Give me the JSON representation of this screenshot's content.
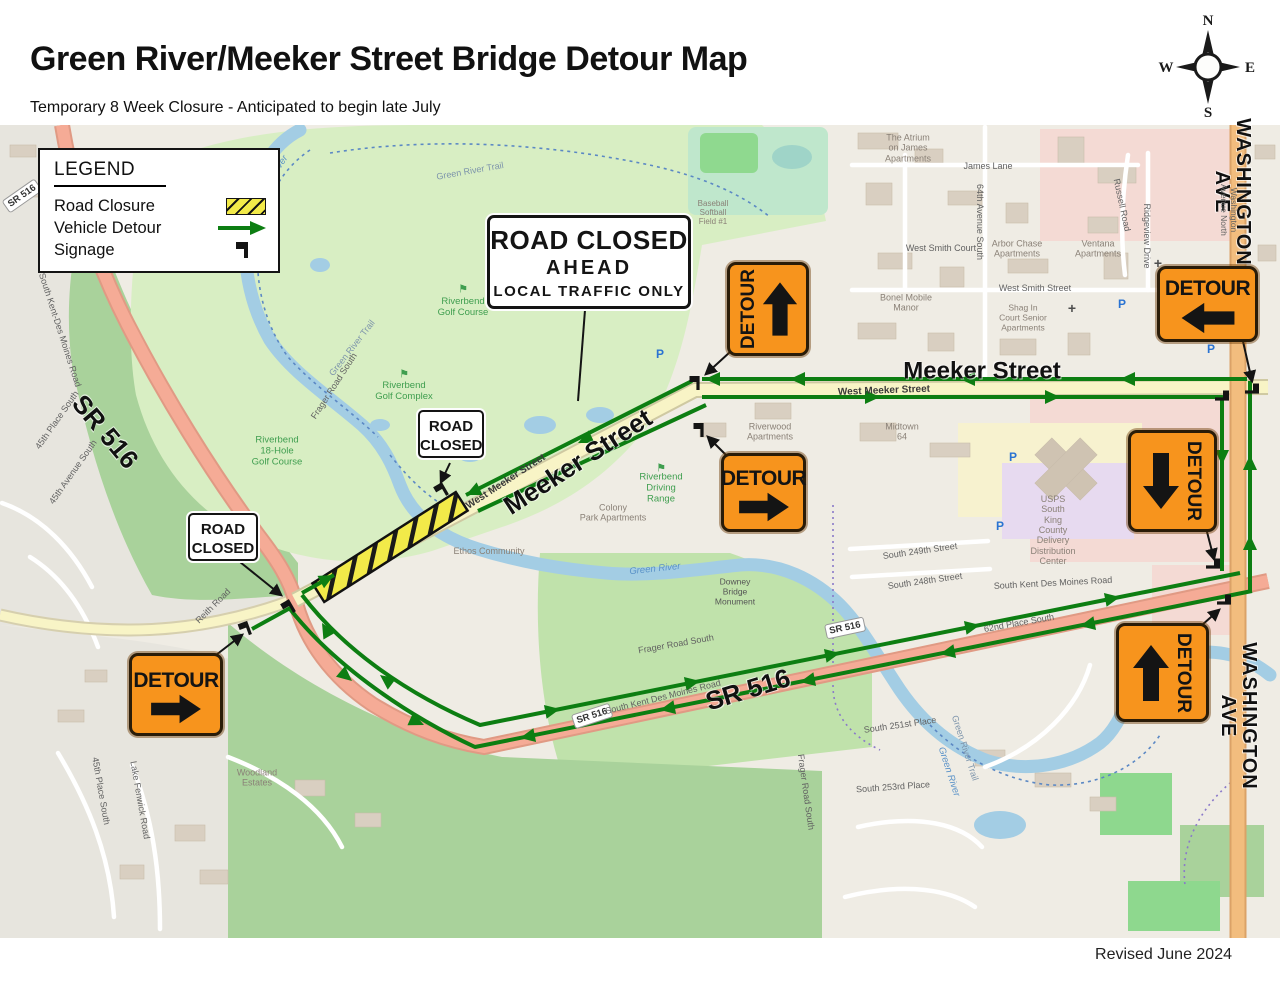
{
  "header": {
    "title": "Green River/Meeker Street Bridge Detour Map",
    "subtitle": "Temporary 8 Week Closure - Anticipated to begin late July"
  },
  "footer": {
    "revised": "Revised June 2024"
  },
  "compass": {
    "n": "N",
    "e": "E",
    "s": "S",
    "w": "W"
  },
  "legend": {
    "title": "LEGEND",
    "road_closure": "Road Closure",
    "vehicle_detour": "Vehicle Detour",
    "signage": "Signage"
  },
  "signs": {
    "road_closed_ahead": {
      "line1": "ROAD CLOSED",
      "line2": "AHEAD",
      "line3": "LOCAL TRAFFIC ONLY"
    },
    "road_closed": "ROAD\nCLOSED",
    "detour": "DETOUR"
  },
  "colors": {
    "detour_green": "#0d7e12",
    "closure_yellow": "#f2ea49",
    "sign_orange": "#f7941d",
    "sr516_road": "#f5ab96",
    "washington_road": "#f2bd7e",
    "meeker_road": "#f8f4c6"
  },
  "map": {
    "street_labels": {
      "sr516_west": "SR 516",
      "sr516_south": "SR 516",
      "meeker_diagonal": "Meeker Street",
      "meeker_east": "Meeker Street",
      "washington_north": "WASHINGTON\nAVE",
      "washington_south": "WASHINGTON\nAVE",
      "shield": "SR 516"
    },
    "parking_glyph": "P",
    "church_glyph": "+",
    "golf_flag": "⚑",
    "labels": [
      "Green River Trail",
      "Green River",
      "Riverbend\nGolf Course",
      "Riverbend\nGolf Complex",
      "Riverbend\n18-Hole\nGolf Course",
      "Riverbend\nDriving\nRange",
      "Frager Road South",
      "West Meeker Street",
      "West Meeker Street",
      "The Atrium\non James\nApartments",
      "James Lane",
      "64th Avenue South",
      "West Smith Court",
      "Arbor Chase\nApartments",
      "Ventana\nApartments",
      "West Smith Street",
      "Bonel Mobile\nManor",
      "Shag In\nCourt Senior\nApartments",
      "Washington Avenue North",
      "Ridgeview Drive",
      "Riverwood\nApartments",
      "Midtown\n64",
      "Colony\nPark Apartments",
      "Ethos Community",
      "Downey\nBridge\nMonument",
      "Green River",
      "USPS\nSouth\nKing\nCounty\nDelivery\nDistribution\nCenter",
      "South 249th Street",
      "South 248th Street",
      "South Kent Des Moines Road",
      "South Kent Des Moines Road",
      "South Kent-Des Moines Road",
      "Frager Road South",
      "Frager Road South",
      "62nd Place South",
      "South 251st Place",
      "South 253rd Place",
      "Green River Trail",
      "Green River",
      "Woodland\nEstates",
      "45th Place South",
      "45th Avenue South",
      "45th Place South",
      "Lake Fenwick Road",
      "Reith Road",
      "Green River Trail",
      "Russell Road",
      "Baseball\nSoftball\nField #1"
    ]
  }
}
